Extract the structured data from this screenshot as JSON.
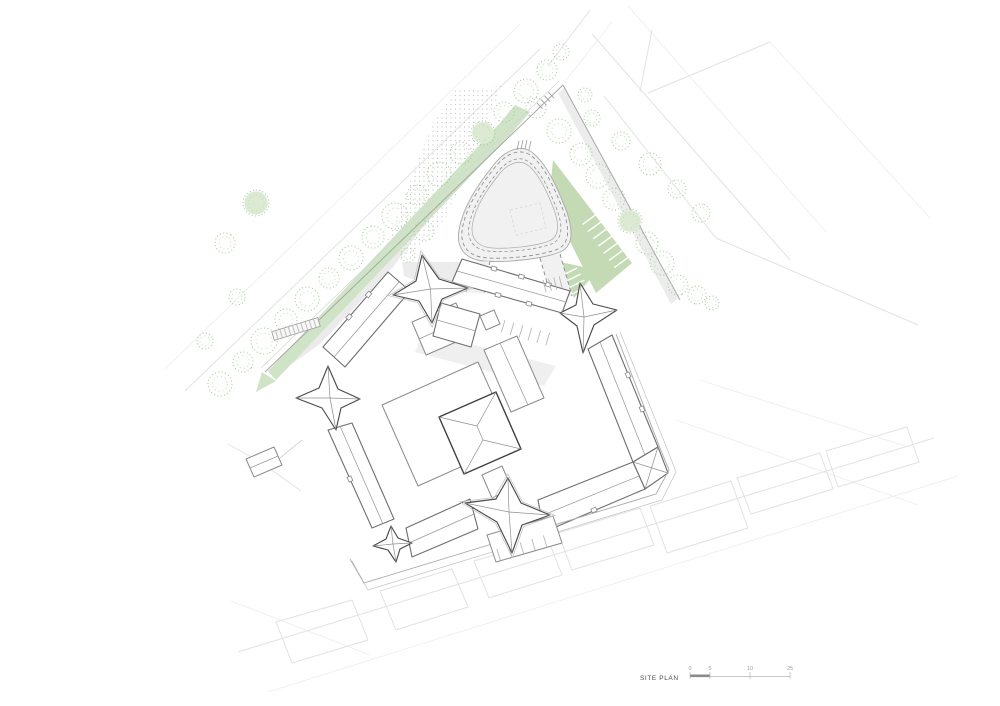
{
  "page": {
    "width": 1000,
    "height": 706,
    "background": "#ffffff"
  },
  "titleblock": {
    "label": "SITE PLAN"
  },
  "scalebar": {
    "labels": [
      "0",
      "5",
      "10",
      "25"
    ]
  },
  "colors": {
    "paper": "#ffffff",
    "context_line": "#e2e2e2",
    "context_line_soft": "#ececec",
    "boundary": "#a8a8a8",
    "road_fill": "#f1f1f1",
    "wash": "#ececec",
    "stipple_dot": "#c7c7c7",
    "green": "#cfe3c6",
    "green_deep": "#c3dab4",
    "tree_stroke": "#a3cb9a",
    "tree_speckle": "#c0dcb6",
    "tree_fill": "#ddead3",
    "building_line": "#6e6e6e",
    "building_line_dark": "#3f3f3f",
    "building_line_soft": "#9a9a9a",
    "eave_line": "#c2c2c2",
    "dash_line": "#8a8a8a",
    "scale_dark": "#8a8a8a",
    "scale_light": "#b5b5b5",
    "label_text": "#4a4a4a",
    "scale_text": "#9a9a9a"
  }
}
